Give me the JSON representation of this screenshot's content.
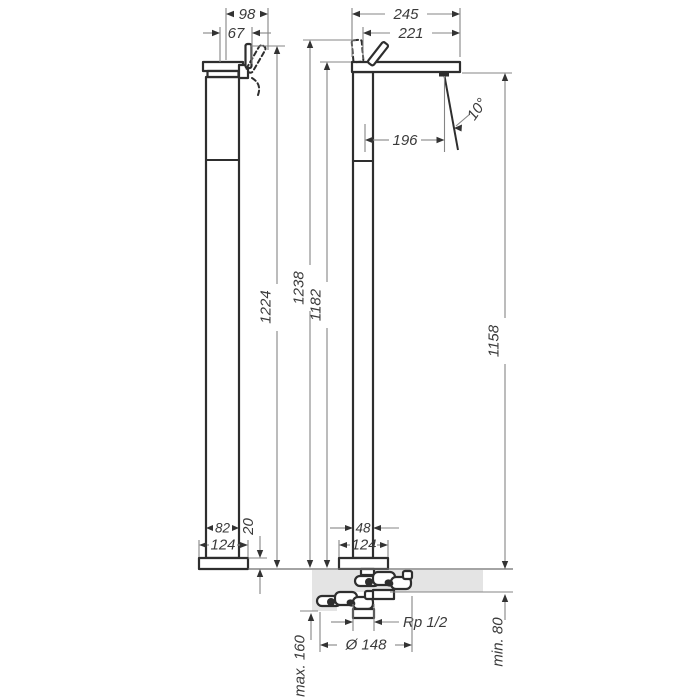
{
  "drawing": {
    "kind": "technical-dimension-drawing",
    "subject": "floor-standing single lever mixer, two orthographic views with installation detail"
  },
  "colors": {
    "background": "#ffffff",
    "part_line": "#2e2e2e",
    "dimension_line": "#858585",
    "arrow": "#333333",
    "floor_fill": "#e4e4e4",
    "text": "#3a3a3a"
  },
  "dims": {
    "side": {
      "overall_depth": "98",
      "top_depth": "67",
      "total_height": "1224",
      "column_depth": "82",
      "base_depth": "124",
      "base_plate_height": "20"
    },
    "front": {
      "spout_overall": "245",
      "spout_reach": "221",
      "stream_offset": "196",
      "stream_angle": "10°",
      "height_to_handle_top": "1238",
      "height_to_spout_top": "1182",
      "height_to_spout_bottom": "1158",
      "column_width": "48",
      "base_width": "124",
      "pipe_connection": "Rp 1/2",
      "floor_min": "min. 80",
      "floor_max": "max. 160",
      "mounting_diameter": "Ø 148"
    }
  }
}
